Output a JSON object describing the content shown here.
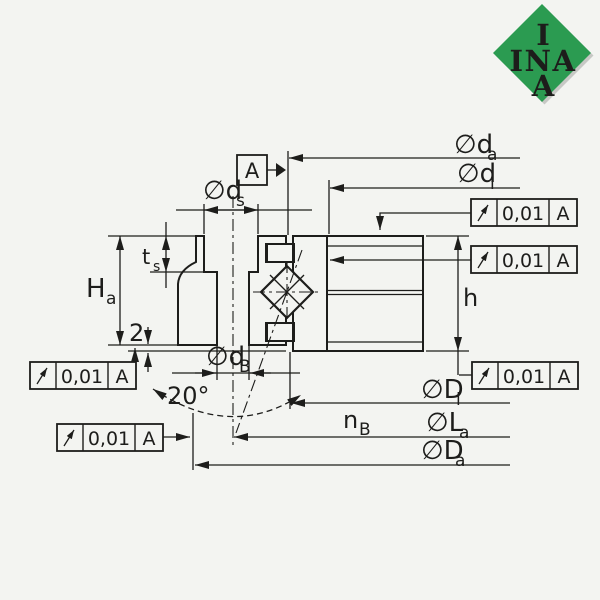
{
  "colors": {
    "background": "#f3f4f1",
    "line": "#1d1d1b",
    "logo_green": "#2b9b51",
    "logo_text": "#ffffff"
  },
  "logo": {
    "line1": "I",
    "line2": "INA",
    "line3": "A"
  },
  "datum_flag": {
    "label": "A"
  },
  "tolerance_frame": {
    "symbol": "circular-runout",
    "value": "0,01",
    "datum": "A"
  },
  "labels": {
    "da": {
      "main": "∅d",
      "sub": "a"
    },
    "di": {
      "main": "∅d",
      "sub": "i"
    },
    "ds": {
      "main": "∅d",
      "sub": "s"
    },
    "dB": {
      "main": "∅d",
      "sub": "B"
    },
    "Di": {
      "main": "∅D",
      "sub": "i"
    },
    "La": {
      "main": "∅L",
      "sub": "a"
    },
    "Da": {
      "main": "∅D",
      "sub": "a"
    },
    "nB": {
      "main": "n",
      "sub": "B"
    },
    "Ha": {
      "main": "H",
      "sub": "a"
    },
    "ts": {
      "main": "t",
      "sub": "s"
    },
    "h": {
      "main": "h",
      "sub": ""
    },
    "offset": "2",
    "angle": "20°"
  }
}
